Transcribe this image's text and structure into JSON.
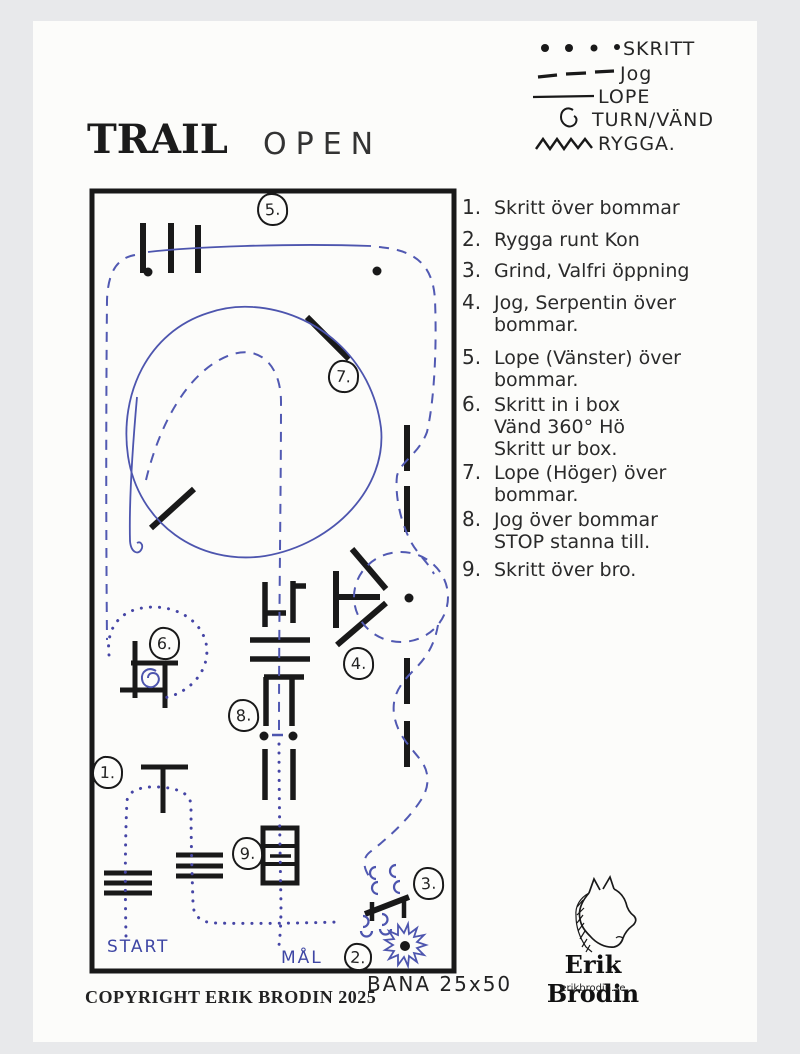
{
  "page": {
    "title_left": "TRAIL",
    "title_right": "OPEN",
    "copyright": "COPYRIGHT ERIK BRODIN 2025",
    "arena_note": "BANA 25x50"
  },
  "legend": {
    "items": [
      {
        "symbol": "dotted-line",
        "label": "SKRITT"
      },
      {
        "symbol": "dashed-line",
        "label": "Jog"
      },
      {
        "symbol": "solid-line",
        "label": "LOPE"
      },
      {
        "symbol": "turn-spiral",
        "label": "TURN/VÄND"
      },
      {
        "symbol": "zigzag-line",
        "label": "RYGGA."
      }
    ]
  },
  "course_list": {
    "items": [
      {
        "num": "1.",
        "lines": [
          "Skritt över bommar"
        ]
      },
      {
        "num": "2.",
        "lines": [
          "Rygga runt Kon"
        ]
      },
      {
        "num": "3.",
        "lines": [
          "Grind, Valfri öppning"
        ]
      },
      {
        "num": "4.",
        "lines": [
          "Jog, Serpentin över",
          "bommar."
        ]
      },
      {
        "num": "5.",
        "lines": [
          "Lope (Vänster) över",
          "bommar."
        ]
      },
      {
        "num": "6.",
        "lines": [
          "Skritt in i box",
          "Vänd 360° Hö",
          "Skritt ur box."
        ]
      },
      {
        "num": "7.",
        "lines": [
          "Lope (Höger) över",
          "bommar."
        ]
      },
      {
        "num": "8.",
        "lines": [
          "Jog över bommar",
          "STOP stanna till."
        ]
      },
      {
        "num": "9.",
        "lines": [
          "Skritt över bro."
        ]
      }
    ]
  },
  "map": {
    "start_label": "START",
    "goal_label": "MÅL",
    "obstacle_numbers": [
      "1.",
      "2.",
      "3.",
      "4.",
      "5.",
      "6.",
      "7.",
      "8.",
      "9."
    ]
  },
  "logo": {
    "name": "Erik Brodin",
    "website": "erikbrodin.se"
  },
  "colors": {
    "ink": "#191919",
    "pen_blue": "#4d55ae",
    "paper": "#fcfcfa",
    "background": "#e8e9eb"
  }
}
